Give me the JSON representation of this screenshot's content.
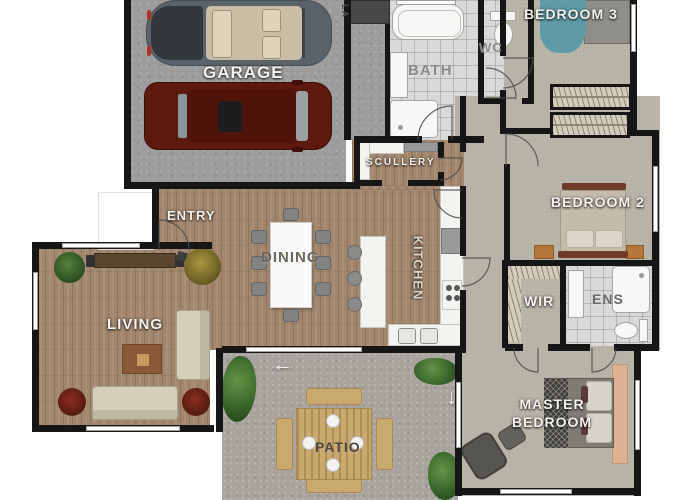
{
  "rooms": {
    "garage": {
      "label": "GARAGE"
    },
    "laundry": {
      "label": "LA"
    },
    "bath": {
      "label": "BATH"
    },
    "wc": {
      "label": "WC"
    },
    "bedroom3": {
      "label": "BEDROOM 3"
    },
    "scullery": {
      "label": "SCULLERY"
    },
    "entry": {
      "label": "ENTRY"
    },
    "dining": {
      "label": "DINING"
    },
    "kitchen": {
      "label": "KITCHEN"
    },
    "bedroom2": {
      "label": "BEDROOM 2"
    },
    "living": {
      "label": "LIVING"
    },
    "wir": {
      "label": "WIR"
    },
    "ens": {
      "label": "ENS"
    },
    "master": {
      "label_line1": "MASTER",
      "label_line2": "BEDROOM"
    },
    "patio": {
      "label": "PATIO"
    }
  },
  "icons": {
    "slide_left_arrow": "←",
    "slide_down_arrow": "↓"
  },
  "colors": {
    "wall": "#161616",
    "wood_floor": "#a2876e",
    "carpet": "#b7b2a6",
    "tile": "#d9d9d9",
    "garage_concrete": "#9c9c9c",
    "patio_concrete": "#a9a59e",
    "label_light": "#f4f2ee",
    "label_dark": "#615d56",
    "bed3_accent_teal": "#5e9ba6",
    "car_red": "#5e190e",
    "car_grey": "#5a636b",
    "sofa_cream": "#d3cfb9",
    "timber_furniture": "#c9a96e"
  }
}
